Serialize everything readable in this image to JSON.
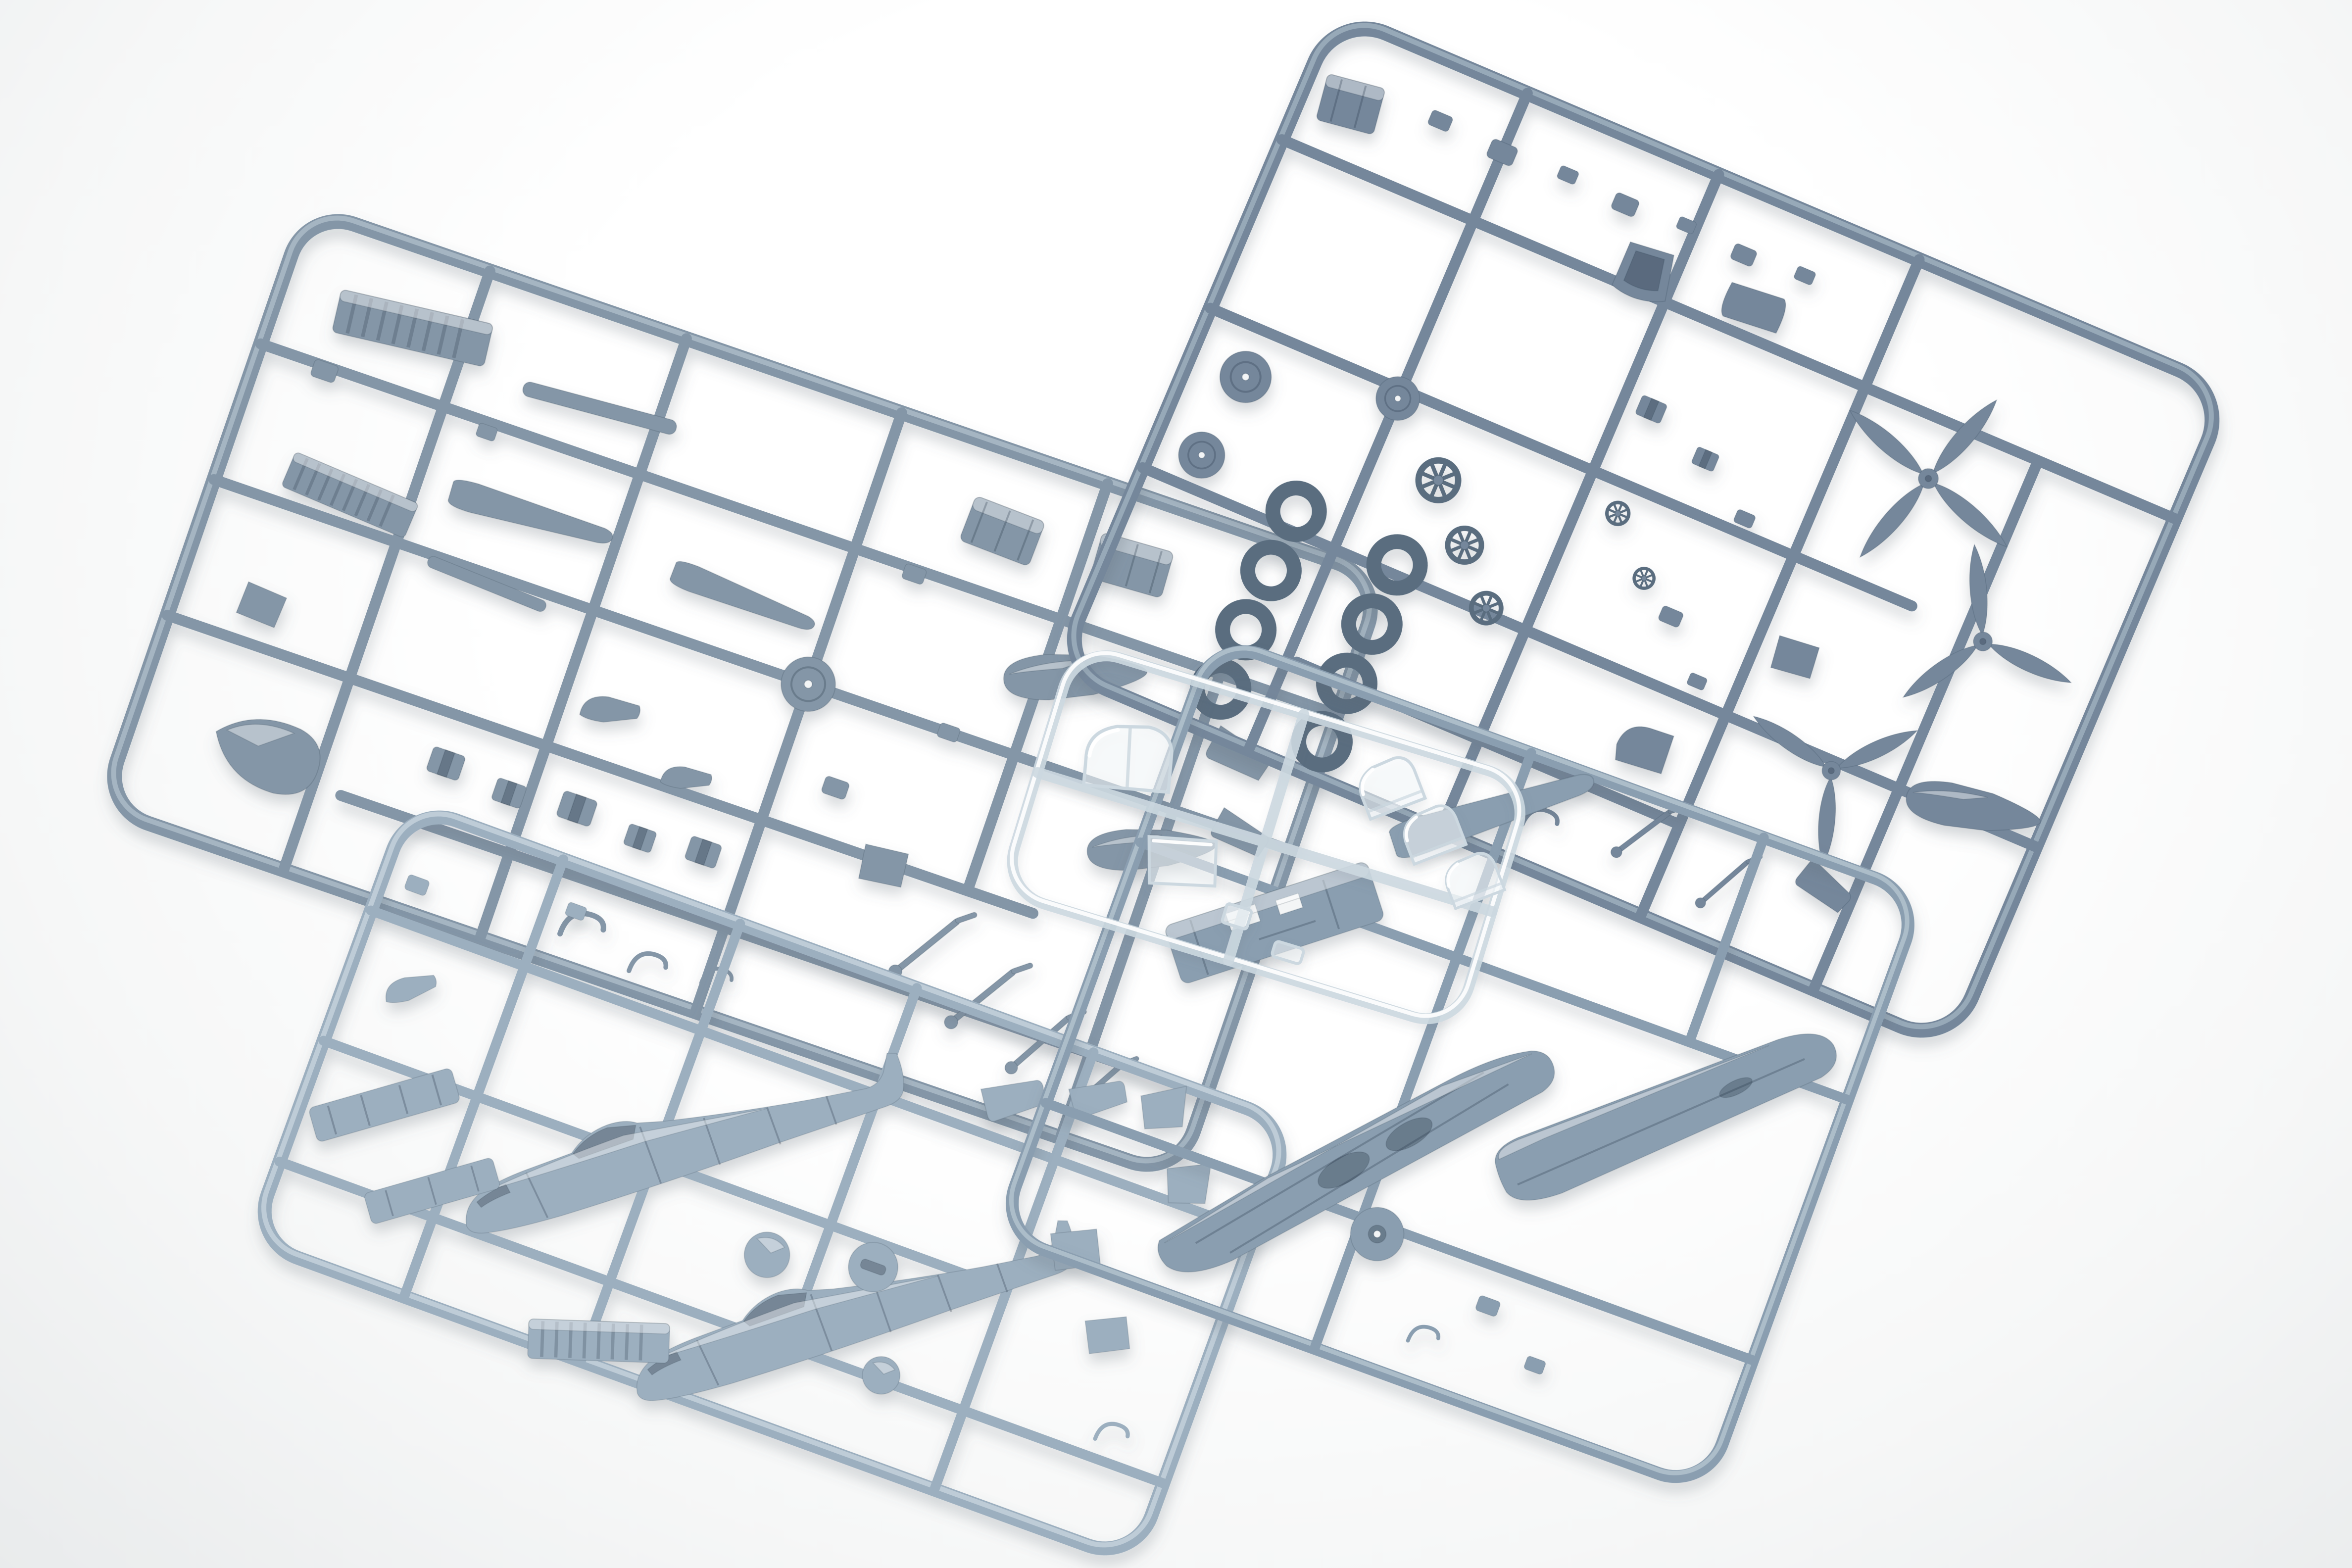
{
  "scene": {
    "type": "photograph",
    "subject": "Unassembled plastic scale-model aircraft kit sprues",
    "setting": "Overhead shot of five injection-molded part frames (sprues) laid out on a seamless white studio background",
    "sprue_count": 5
  },
  "colors": {
    "bg_center": "#ffffff",
    "bg_mid": "#f6f7f7",
    "bg_edge": "#e9ebec",
    "plastic_a": "#74879b",
    "plastic_a_dark": "#5a6d7f",
    "plastic_a_light": "#a3b4c2",
    "plastic_b": "#8496a7",
    "plastic_b_dark": "#647789",
    "plastic_b_light": "#b0bfcb",
    "plastic_c": "#9cafbf",
    "plastic_c_dark": "#7b8ea1",
    "plastic_c_light": "#c9d6df",
    "plastic_d": "#8a9eb0",
    "plastic_d_dark": "#6b7e91",
    "plastic_d_light": "#b7c7d2",
    "clear_fill": "rgba(245,250,252,0.55)",
    "clear_stroke": "#ccd8e0",
    "clear_highlight": "#ffffff",
    "part_edge": "rgba(40,55,70,0.22)",
    "shadow": "#5a6673"
  },
  "sprues": [
    {
      "name": "detail sprue",
      "position": "top right",
      "material": "gray-blue styrene",
      "contents": [
        "four-blade propeller",
        "three-blade propeller x2",
        "tires x8",
        "wheel hub discs x3",
        "spoked control wheels x3",
        "drop tank",
        "seat and cockpit fittings",
        "undercarriage parts"
      ]
    },
    {
      "name": "small-parts sprue",
      "position": "left",
      "material": "gray-blue styrene",
      "contents": [
        "horizontal stabilizers",
        "radiator housings x2",
        "ribbed cooling flaps x2",
        "drop tanks x2",
        "spinner cone",
        "landing-gear legs x4",
        "bulkheads and many small fittings"
      ]
    },
    {
      "name": "fuselage sprue",
      "position": "bottom left",
      "material": "gray-blue styrene",
      "contents": [
        "fuselage halves x2",
        "cockpit sidewalls x2",
        "spinner dome and backplate",
        "tail surfaces x4",
        "ribbed radiator flap"
      ]
    },
    {
      "name": "wing sprue",
      "position": "center right",
      "material": "gray-blue styrene",
      "contents": [
        "one-piece lower wing",
        "upper wing panel",
        "horizontal stabilizer",
        "gun-deck cowling with cutouts",
        "main wheel"
      ]
    },
    {
      "name": "clear sprue",
      "position": "center",
      "material": "transparent styrene",
      "contents": [
        "windscreen",
        "canopy hood x3",
        "rear glazing panel",
        "gunsight glass"
      ]
    }
  ]
}
